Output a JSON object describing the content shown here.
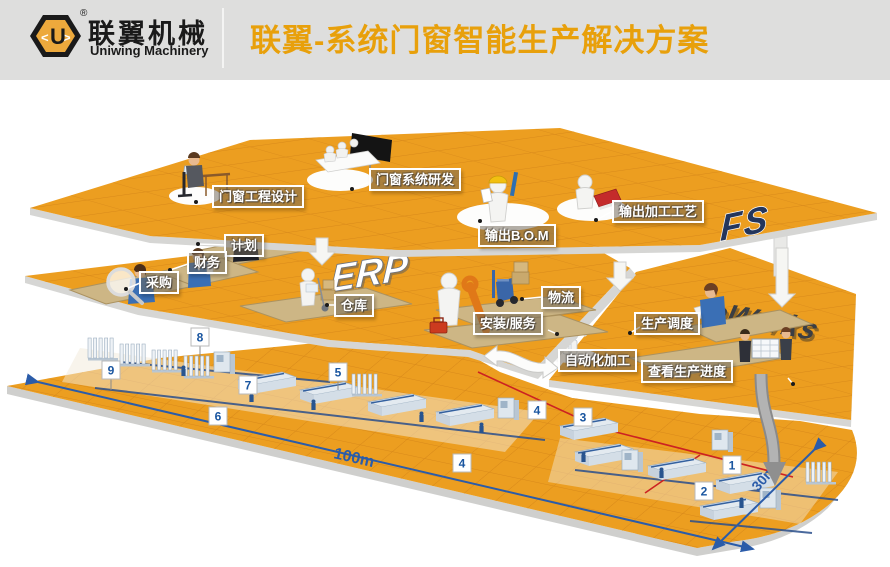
{
  "header": {
    "logo_cn": "联翼机械",
    "logo_en": "Uniwing Machinery",
    "logo_letter": "U",
    "registered": "®",
    "title": "联翼-系统门窗智能生产解决方案"
  },
  "layers": {
    "design": {
      "logo": "FS",
      "items": {
        "engineering": "门窗工程设计",
        "rnd": "门窗系统研发",
        "bom": "输出B.O.M",
        "process": "输出加工工艺"
      }
    },
    "erp": {
      "logo": "ERP",
      "items": {
        "plan": "计划",
        "finance": "财务",
        "purchase": "采购",
        "warehouse": "仓库",
        "logistics": "物流",
        "install": "安装/服务"
      }
    },
    "eworks": {
      "logo": "eWorks",
      "items": {
        "scheduling": "生产调度",
        "auto": "自动化加工",
        "progress": "查看生产进度"
      }
    }
  },
  "floor": {
    "stations": [
      "1",
      "2",
      "3",
      "4",
      "5",
      "6",
      "7",
      "8",
      "9"
    ],
    "dim_length": "100m",
    "dim_width": "30m"
  },
  "colors": {
    "floor_orange": "#EC9E20",
    "accent_orange": "#E8A00B",
    "dim_blue": "#2B5CA9",
    "route_red": "#CC2222",
    "logo_yellow": "#EDA93C"
  }
}
